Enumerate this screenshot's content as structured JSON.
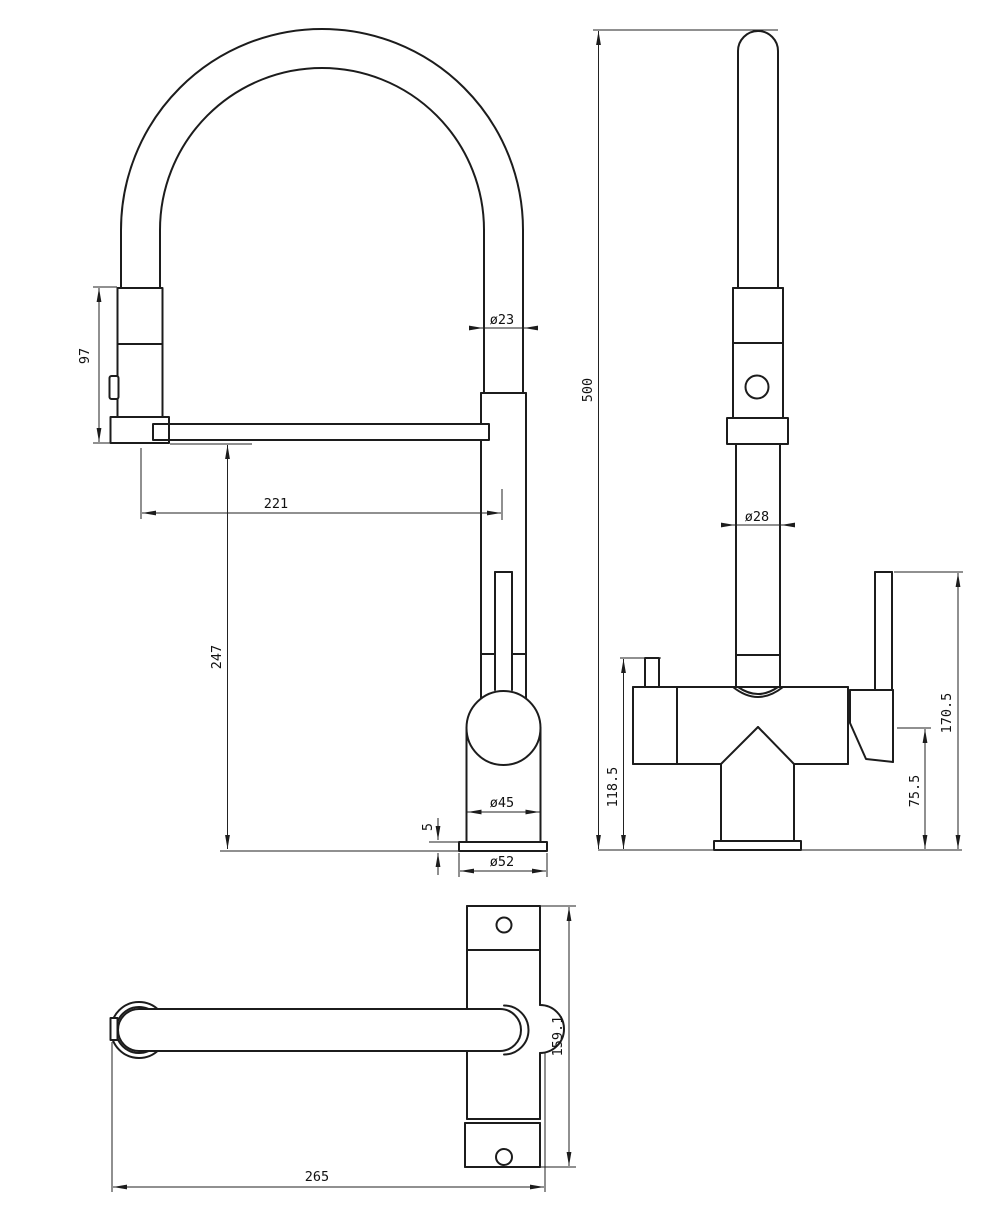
{
  "drawing": {
    "background_color": "#ffffff",
    "line_color": "#1c1c1c",
    "views": {
      "front_view": {
        "name": "front-view",
        "dims": {
          "spray_head_height": "97",
          "hose_diameter": "ø23",
          "reach_to_axis": "221",
          "spout_underside_height": "247",
          "body_diameter": "ø45",
          "base_plate_thickness": "5",
          "base_diameter": "ø52"
        }
      },
      "side_view": {
        "name": "side-view",
        "dims": {
          "overall_height": "500",
          "column_diameter": "ø28",
          "filter_lever_height": "118.5",
          "handle_base_height": "75.5",
          "handle_top_height": "170.5"
        }
      },
      "top_view": {
        "name": "top-view",
        "dims": {
          "depth": "159.1",
          "overall_length": "265"
        }
      }
    }
  }
}
